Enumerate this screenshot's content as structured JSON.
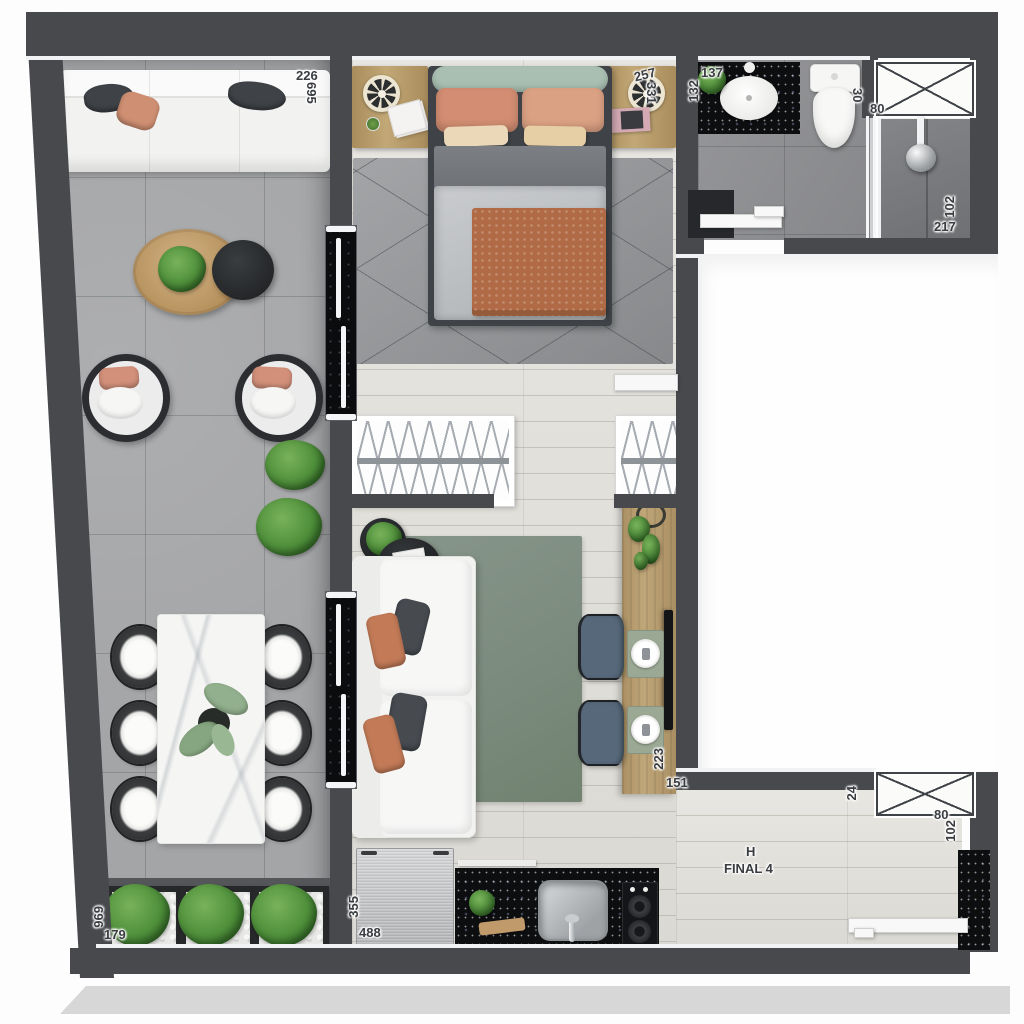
{
  "unit": {
    "block_letter": "H",
    "unit_name": "FINAL 4"
  },
  "dimensions": {
    "sofa_width": "226",
    "terrace_length": "695",
    "bed_width": "257",
    "bedroom_length": "331",
    "vanity_width": "137",
    "vanity_depth": "132",
    "toilet_offset": "30",
    "shower_door_width": "80",
    "shower_length": "217",
    "shower_width": "102",
    "tv_counter_length": "223",
    "counter_offset": "151",
    "br_window_offset": "24",
    "br_window_width": "80",
    "br_window_depth": "102",
    "kitchen_depth": "355",
    "kitchen_width": "488",
    "planter_run_length": "969",
    "planter_depth": "179"
  },
  "colors": {
    "wall": "#47494d",
    "plank_floor": "#e2e0da",
    "terrace_tile": "#a4a5a7",
    "bath_tile": "#8f9093",
    "shower_tile": "#7b7c7f",
    "granite_black": "#0d0e10",
    "wood": "#b49a6e",
    "rug_green": "#7f8f81",
    "rug_gray": "#96989b",
    "salmon": "#cd8a6b",
    "plant_green": "#4e8f3a",
    "label_text": "#393c40"
  },
  "icons": {
    "window": "window-x-icon",
    "shower_head": "shower-head-icon",
    "wheel_clock": "wheel-clock-icon",
    "hangers": "hanger-rail-icon",
    "plant": "plant-icon"
  }
}
